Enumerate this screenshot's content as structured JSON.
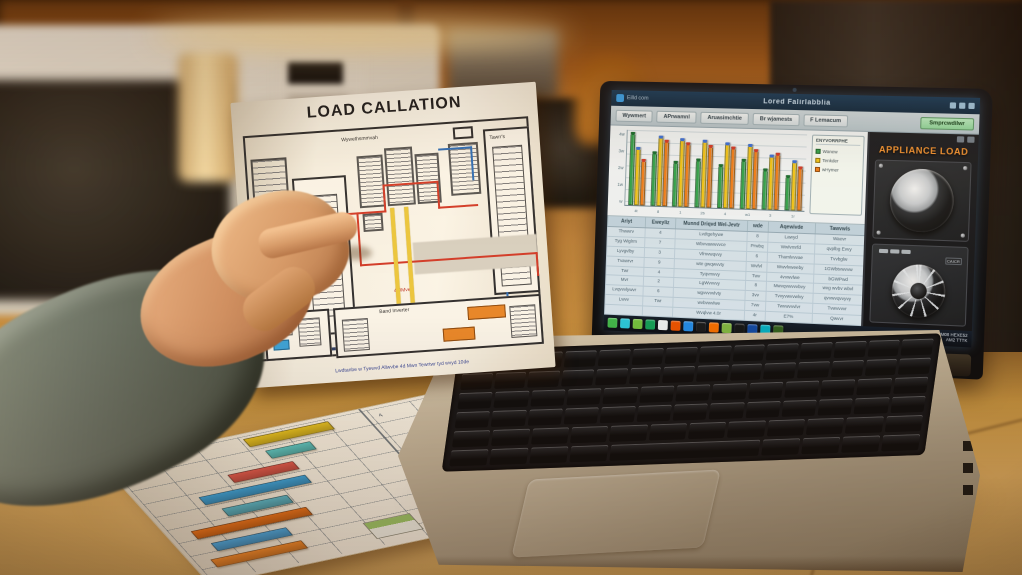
{
  "palette": {
    "counter": "#c89a5c",
    "cabinet": "#a05a1c",
    "glow": "#ffdf9a",
    "appliance_title": "#f09335",
    "action_green": "#9fd9a8"
  },
  "diagram_paper": {
    "title": "LOAD CALLATION",
    "side_label": "E B S A Y 8",
    "labels": {
      "top_center": "Wywethsmmvah",
      "mid_left": "Bihyet",
      "right_panel": "Tawrr's",
      "right_mid_note": "Gvwvr",
      "bottom_panel": "Band Inverter",
      "wire_note": "4-0Mve"
    },
    "caption": "Lwdtanbe w Tyewvd Allwvbe 4d Mwn Tewrtwr tyd wvyd 10de"
  },
  "screen": {
    "titlebar": {
      "app": "Eilld com",
      "title": "Lored Falirlabblia",
      "window_icons": [
        "minimize-icon",
        "maximize-icon",
        "close-icon"
      ]
    },
    "toolbar": {
      "tabs": [
        "Wywmert",
        "APrwamnl",
        "Aruasimchtie",
        "Br wjamests",
        "F Lemacum"
      ],
      "action": "Smprcwdilwr"
    },
    "chart_data": {
      "type": "bar",
      "title": "",
      "categories": [
        "4t",
        "8",
        "1",
        "2b",
        "4",
        "w1",
        "3",
        "1r"
      ],
      "series": [
        {
          "name": "Wanew",
          "color": "#2fa24c",
          "cap": "#176c31",
          "values": [
            97,
            72,
            60,
            64,
            58,
            66,
            54,
            46
          ]
        },
        {
          "name": "Tenkder",
          "color": "#f0c419",
          "cap": "#3a6fd8",
          "values": [
            78,
            93,
            91,
            89,
            87,
            85,
            72,
            66
          ]
        },
        {
          "name": "wHymer",
          "color": "#ef7d1a",
          "cap": "#cf3a2a",
          "values": [
            62,
            88,
            85,
            83,
            82,
            79,
            75,
            58
          ]
        }
      ],
      "ylim": [
        0,
        100
      ],
      "y_ticks": [
        "4w",
        "3w",
        "2w",
        "1w",
        "w"
      ],
      "legend_title": "ENYVORRPHE",
      "legend_position": "right",
      "grid": true
    },
    "table": {
      "headers": [
        "Ariyt",
        "Eweyliz",
        "Munnd Driqvd Wel-Jevtr",
        "wde",
        "Aqewivde",
        "Tawvwls"
      ],
      "rows": [
        [
          "Thwwrv",
          "4",
          "Lvdtgehywe",
          "8",
          "Lawyd",
          "Waevr"
        ],
        [
          "Tyg Wiglrm",
          "7",
          "Wbvvawwvvce",
          "Prwbq",
          "Wwlvmrfd",
          "qvplbg Evvy"
        ],
        [
          "Lyvgvlby",
          "3",
          "Vfmvwqvvy",
          "6",
          "Thamlvvvae",
          "Tvvbglw"
        ],
        [
          "Tvawrvr",
          "9",
          "wte gwqwvvty",
          "Wvfvl",
          "Wwvlvweeby",
          "1GWbtvwvvw"
        ],
        [
          "Twr",
          "4",
          "Tyqvmvvy",
          "Twv",
          "4vvwvlwe",
          "bGWPwd"
        ],
        [
          "Mvr",
          "2",
          "LgWvvvvy",
          "8",
          "Mwvqvwvvvbvy",
          "wvg wvbv wbvl"
        ],
        [
          "Lvqvvvlywvr",
          "6",
          "wgvvvvvlvty",
          "3vv",
          "Tvvyvwvvwlvy",
          "qvvwvqvvyvy"
        ],
        [
          "Lwvv",
          "Twr",
          "wvbvwvlwe",
          "7vw",
          "Twvwvvvlvr",
          "Tvwvvvvr"
        ],
        [
          "",
          "",
          "Wvqlvw 4.0r",
          "4r",
          "E7%",
          "Qwvvr"
        ]
      ]
    },
    "appliance_panel": {
      "title": "APPLIANCE LOAD",
      "dial2_label": "CAICR",
      "corner_icons": [
        "speaker-icon",
        "grid-icon"
      ]
    },
    "taskbar": {
      "icon_colors": [
        "#3db54a",
        "#26c6da",
        "#6fbf3e",
        "#0f9d58",
        "#e8eef2",
        "#e65100",
        "#1e88e5",
        "#15181c",
        "#ef6c00",
        "#7cb342",
        "#101417",
        "#0d47a1",
        "#00acc1",
        "#2e5d1f"
      ],
      "tray_line1": "PM08 HEXE52",
      "tray_line2": "AM2 TTTK"
    },
    "brand": "WONWYF"
  },
  "bottom_paper": {
    "chart_data": {
      "type": "bar",
      "orientation": "horizontal",
      "bars": [
        {
          "color": "#e6c322",
          "offset": 52,
          "length": 34
        },
        {
          "color": "#5bc8c4",
          "offset": 56,
          "length": 18
        },
        {
          "color": "#e05a4e",
          "offset": 36,
          "length": 26
        },
        {
          "color": "#3aa4dc",
          "offset": 20,
          "length": 42
        },
        {
          "color": "#59b8c9",
          "offset": 24,
          "length": 26
        },
        {
          "color": "#e8731c",
          "offset": 7,
          "length": 46
        },
        {
          "color": "#4aa8e0",
          "offset": 10,
          "length": 30
        },
        {
          "color": "#f08a2d",
          "offset": 5,
          "length": 36
        }
      ]
    },
    "cell_notes": [
      "4",
      "8",
      "1S",
      "2v",
      "8h",
      "w4",
      "3e"
    ],
    "thumbnails": [
      "photo-thumbnail-dark",
      "photo-thumbnail-green",
      "card-thumbnail-teal",
      "card-thumbnail-orange"
    ]
  }
}
